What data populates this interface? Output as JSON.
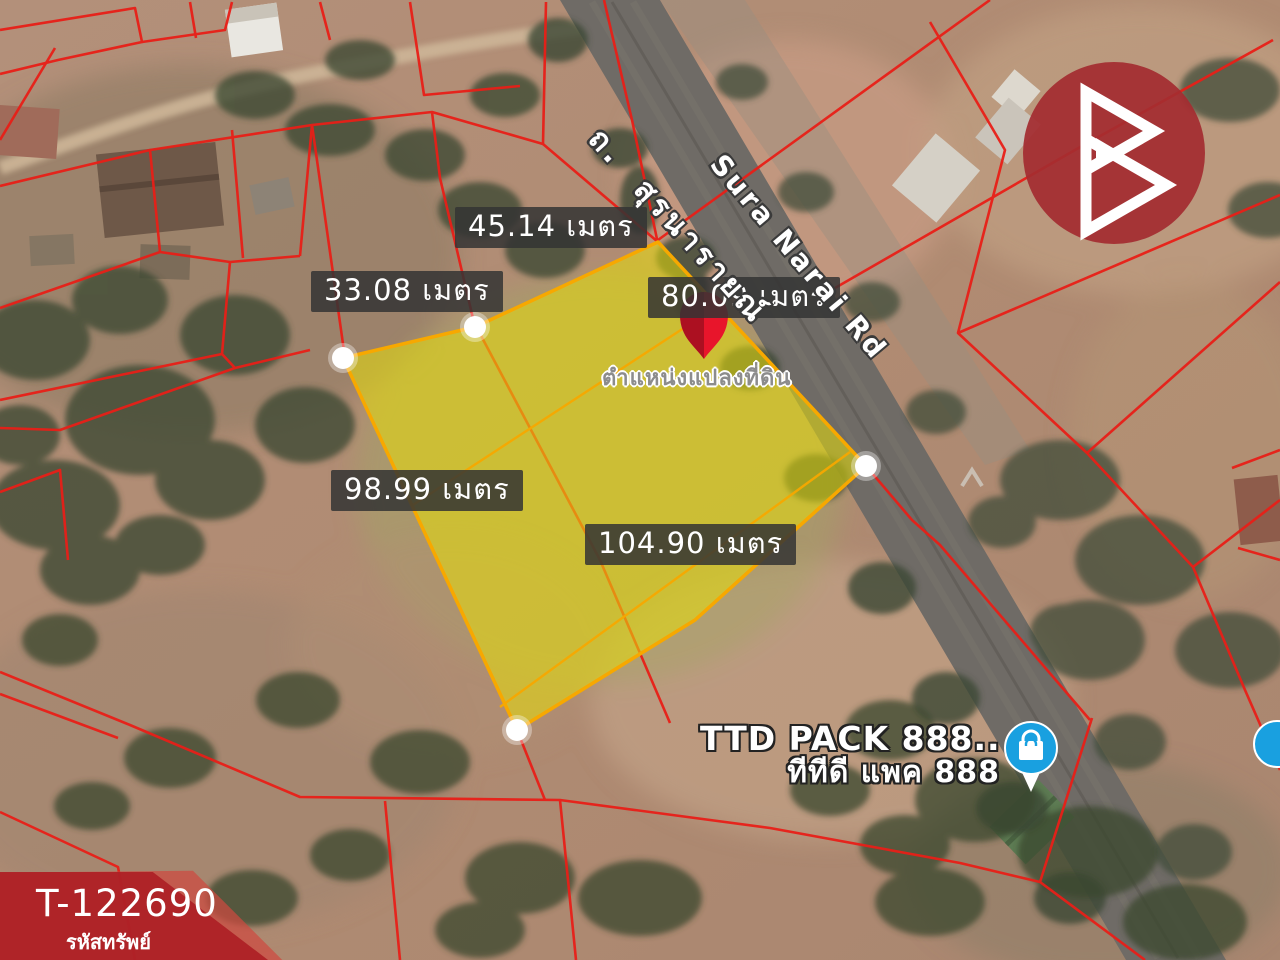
{
  "map": {
    "plot_location_label": "ตำแหน่งแปลงที่ดิน",
    "road": {
      "name_thai": "ถ. สุรนารายณ์",
      "name_english": "Sura Narai Rd"
    },
    "measurements": [
      {
        "side": "top",
        "text": "45.14 เมตร"
      },
      {
        "side": "northwest",
        "text": "33.08 เมตร"
      },
      {
        "side": "road-side",
        "text": "80.09 เมตร"
      },
      {
        "side": "southwest",
        "text": "98.99 เมตร"
      },
      {
        "side": "south",
        "text": "104.90 เมตร"
      }
    ],
    "poi": {
      "name_english": "TTD PACK 888..",
      "name_thai": "ทีทีดี แพค 888"
    }
  },
  "watermark": {
    "property_code": "T-122690",
    "property_code_caption": "รหัสทรัพย์"
  },
  "icons": {
    "plot_pin": "location-pin-icon",
    "poi_pin": "shop-bag-pin-icon",
    "brand": "brand-logo-icon"
  },
  "colors": {
    "parcel_line": "#e81f18",
    "plot_fill": "#e8de0a",
    "plot_stroke": "#f7a800",
    "pin_red": "#e8152b",
    "poi_blue": "#19a0e0",
    "brand_red": "#a42c30",
    "ribbon_red": "#ac1e25",
    "label_bg": "#343434"
  }
}
